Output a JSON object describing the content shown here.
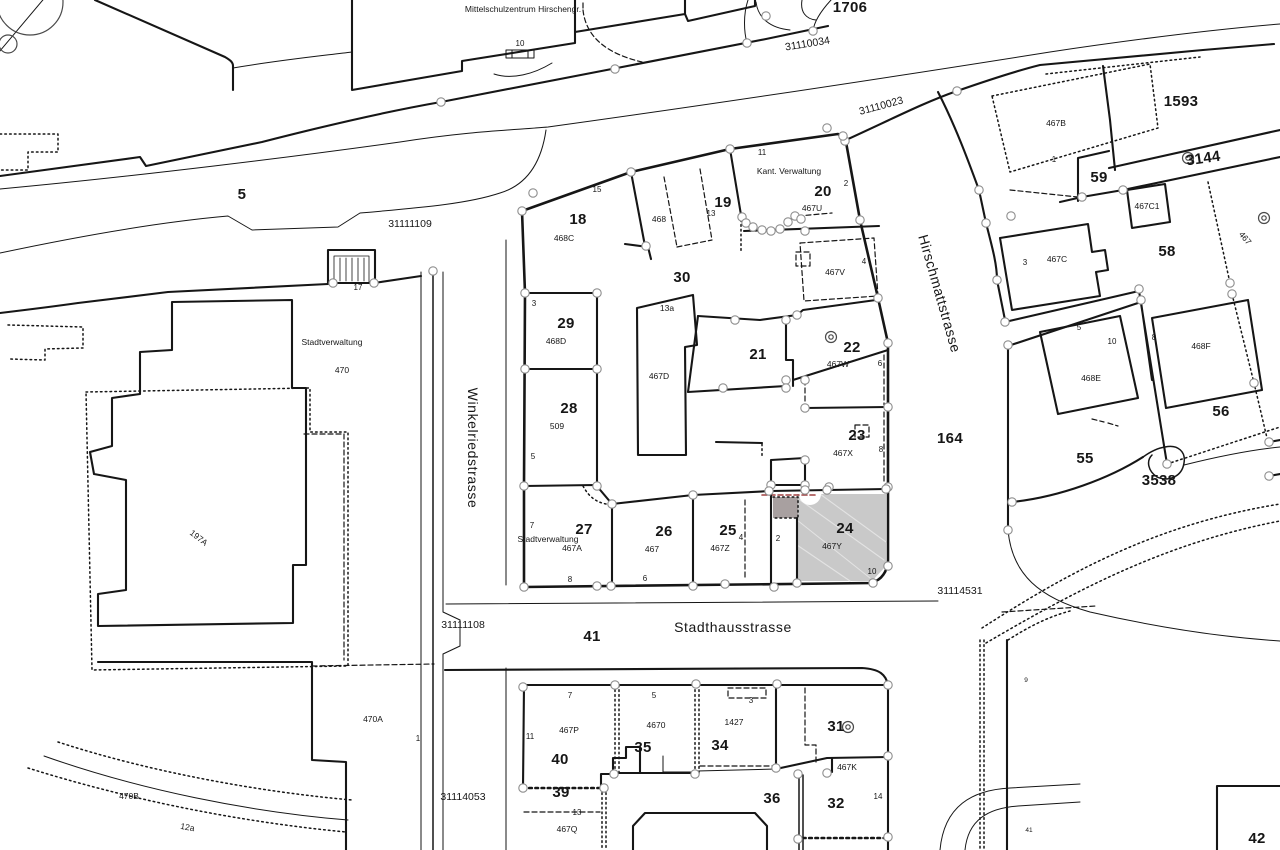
{
  "meta": {
    "map_kind": "cadastral parcel map"
  },
  "colors": {
    "background": "#ffffff",
    "line": "#161616",
    "survey_point_stroke": "#8d8d8d",
    "highlight_parcel_fill": "#c9c9c9",
    "highlight_subarea_fill": "#a8a0a0",
    "annotation_red": "#a04040"
  },
  "streets": [
    "Winkelriedstrasse",
    "Stadthausstrasse",
    "Hirschmattstrasse"
  ],
  "places": [
    "Mittelschulzentrum Hirschengr.",
    "Kant. Verwaltung",
    "Stadtverwaltung"
  ],
  "road_ids": [
    "31110034",
    "31110023",
    "31111109",
    "31111108",
    "31114053",
    "31114531"
  ],
  "highlighted_parcel": {
    "number": "24",
    "building": "467Y"
  },
  "labels": [
    {
      "t": "Mittelschulzentrum Hirschengr.",
      "x": 523,
      "y": 12,
      "c": "note"
    },
    {
      "t": "1706",
      "x": 850,
      "y": 12,
      "c": "p"
    },
    {
      "t": "31110034",
      "x": 808,
      "y": 47,
      "c": "road",
      "r": -9
    },
    {
      "t": "31110023",
      "x": 882,
      "y": 109,
      "c": "road",
      "r": -15
    },
    {
      "t": "10",
      "x": 520,
      "y": 46,
      "c": "h"
    },
    {
      "t": "5",
      "x": 242,
      "y": 199,
      "c": "p"
    },
    {
      "t": "31111109",
      "x": 410,
      "y": 227,
      "c": "road"
    },
    {
      "t": "17",
      "x": 358,
      "y": 290,
      "c": "h"
    },
    {
      "t": "Stadtverwaltung",
      "x": 332,
      "y": 345,
      "c": "note"
    },
    {
      "t": "470",
      "x": 342,
      "y": 373,
      "c": "b"
    },
    {
      "t": "197A",
      "x": 197,
      "y": 540,
      "c": "b",
      "r": 38
    },
    {
      "t": "470A",
      "x": 373,
      "y": 722,
      "c": "b"
    },
    {
      "t": "1",
      "x": 418,
      "y": 741,
      "c": "h"
    },
    {
      "t": "470B",
      "x": 129,
      "y": 799,
      "c": "b"
    },
    {
      "t": "12a",
      "x": 187,
      "y": 830,
      "c": "b",
      "r": 10
    },
    {
      "t": "Winkelriedstrasse",
      "x": 468,
      "y": 448,
      "c": "st",
      "r": 90
    },
    {
      "t": "31111108",
      "x": 463,
      "y": 628,
      "c": "road"
    },
    {
      "t": "31114053",
      "x": 463,
      "y": 800,
      "c": "road"
    },
    {
      "t": "18",
      "x": 578,
      "y": 224,
      "c": "p"
    },
    {
      "t": "468C",
      "x": 564,
      "y": 241,
      "c": "b"
    },
    {
      "t": "15",
      "x": 597,
      "y": 192,
      "c": "h"
    },
    {
      "t": "468",
      "x": 659,
      "y": 222,
      "c": "b"
    },
    {
      "t": "19",
      "x": 723,
      "y": 207,
      "c": "p"
    },
    {
      "t": "13",
      "x": 711,
      "y": 216,
      "c": "h"
    },
    {
      "t": "Kant. Verwaltung",
      "x": 789,
      "y": 174,
      "c": "note"
    },
    {
      "t": "20",
      "x": 823,
      "y": 196,
      "c": "p"
    },
    {
      "t": "11",
      "x": 762,
      "y": 155,
      "c": "h"
    },
    {
      "t": "2",
      "x": 846,
      "y": 186,
      "c": "h"
    },
    {
      "t": "467U",
      "x": 812,
      "y": 211,
      "c": "b"
    },
    {
      "t": "467V",
      "x": 835,
      "y": 275,
      "c": "b"
    },
    {
      "t": "4",
      "x": 864,
      "y": 264,
      "c": "h"
    },
    {
      "t": "30",
      "x": 682,
      "y": 282,
      "c": "p"
    },
    {
      "t": "3",
      "x": 534,
      "y": 306,
      "c": "h"
    },
    {
      "t": "29",
      "x": 566,
      "y": 328,
      "c": "p"
    },
    {
      "t": "468D",
      "x": 556,
      "y": 344,
      "c": "b"
    },
    {
      "t": "28",
      "x": 569,
      "y": 413,
      "c": "p"
    },
    {
      "t": "509",
      "x": 557,
      "y": 429,
      "c": "b"
    },
    {
      "t": "5",
      "x": 533,
      "y": 459,
      "c": "h"
    },
    {
      "t": "13a",
      "x": 667,
      "y": 311,
      "c": "b"
    },
    {
      "t": "467D",
      "x": 659,
      "y": 379,
      "c": "b"
    },
    {
      "t": "21",
      "x": 758,
      "y": 359,
      "c": "p"
    },
    {
      "t": "22",
      "x": 852,
      "y": 352,
      "c": "p"
    },
    {
      "t": "467W",
      "x": 838,
      "y": 367,
      "c": "b"
    },
    {
      "t": "6",
      "x": 880,
      "y": 366,
      "c": "h"
    },
    {
      "t": "23",
      "x": 857,
      "y": 440,
      "c": "p"
    },
    {
      "t": "467X",
      "x": 843,
      "y": 456,
      "c": "b"
    },
    {
      "t": "8",
      "x": 881,
      "y": 452,
      "c": "h"
    },
    {
      "t": "Hirschmattstrasse",
      "x": 935,
      "y": 295,
      "c": "st",
      "r": 74
    },
    {
      "t": "164",
      "x": 950,
      "y": 443,
      "c": "p"
    },
    {
      "t": "27",
      "x": 584,
      "y": 534,
      "c": "p"
    },
    {
      "t": "Stadtverwaltung",
      "x": 548,
      "y": 542,
      "c": "note"
    },
    {
      "t": "467A",
      "x": 572,
      "y": 551,
      "c": "b"
    },
    {
      "t": "7",
      "x": 532,
      "y": 528,
      "c": "h"
    },
    {
      "t": "8",
      "x": 570,
      "y": 582,
      "c": "h"
    },
    {
      "t": "26",
      "x": 664,
      "y": 536,
      "c": "p"
    },
    {
      "t": "467",
      "x": 652,
      "y": 552,
      "c": "b"
    },
    {
      "t": "6",
      "x": 645,
      "y": 581,
      "c": "h"
    },
    {
      "t": "25",
      "x": 728,
      "y": 535,
      "c": "p"
    },
    {
      "t": "467Z",
      "x": 720,
      "y": 551,
      "c": "b"
    },
    {
      "t": "4",
      "x": 741,
      "y": 540,
      "c": "h"
    },
    {
      "t": "24",
      "x": 845,
      "y": 533,
      "c": "p"
    },
    {
      "t": "467Y",
      "x": 832,
      "y": 549,
      "c": "b"
    },
    {
      "t": "2",
      "x": 778,
      "y": 541,
      "c": "h"
    },
    {
      "t": "10",
      "x": 872,
      "y": 574,
      "c": "h"
    },
    {
      "t": "41",
      "x": 592,
      "y": 641,
      "c": "p"
    },
    {
      "t": "Stadthausstrasse",
      "x": 733,
      "y": 632,
      "c": "st"
    },
    {
      "t": "31114531",
      "x": 960,
      "y": 594,
      "c": "road"
    },
    {
      "t": "40",
      "x": 560,
      "y": 764,
      "c": "p"
    },
    {
      "t": "467P",
      "x": 569,
      "y": 733,
      "c": "b"
    },
    {
      "t": "11",
      "x": 530,
      "y": 739,
      "c": "h"
    },
    {
      "t": "7",
      "x": 570,
      "y": 698,
      "c": "h"
    },
    {
      "t": "35",
      "x": 643,
      "y": 752,
      "c": "p"
    },
    {
      "t": "4670",
      "x": 656,
      "y": 728,
      "c": "b"
    },
    {
      "t": "5",
      "x": 654,
      "y": 698,
      "c": "h"
    },
    {
      "t": "34",
      "x": 720,
      "y": 750,
      "c": "p"
    },
    {
      "t": "1427",
      "x": 734,
      "y": 725,
      "c": "b"
    },
    {
      "t": "3",
      "x": 751,
      "y": 703,
      "c": "h"
    },
    {
      "t": "31",
      "x": 836,
      "y": 731,
      "c": "p"
    },
    {
      "t": "36",
      "x": 772,
      "y": 803,
      "c": "p"
    },
    {
      "t": "32",
      "x": 836,
      "y": 808,
      "c": "p"
    },
    {
      "t": "467K",
      "x": 847,
      "y": 770,
      "c": "b"
    },
    {
      "t": "14",
      "x": 878,
      "y": 799,
      "c": "h"
    },
    {
      "t": "39",
      "x": 561,
      "y": 797,
      "c": "p"
    },
    {
      "t": "13",
      "x": 577,
      "y": 815,
      "c": "h"
    },
    {
      "t": "467Q",
      "x": 567,
      "y": 832,
      "c": "b"
    },
    {
      "t": "467B",
      "x": 1056,
      "y": 126,
      "c": "b"
    },
    {
      "t": "1",
      "x": 1054,
      "y": 162,
      "c": "h"
    },
    {
      "t": "1593",
      "x": 1181,
      "y": 106,
      "c": "p"
    },
    {
      "t": "59",
      "x": 1099,
      "y": 182,
      "c": "p"
    },
    {
      "t": "3144",
      "x": 1204,
      "y": 163,
      "c": "p",
      "r": -8
    },
    {
      "t": "467C1",
      "x": 1147,
      "y": 209,
      "c": "b"
    },
    {
      "t": "58",
      "x": 1167,
      "y": 256,
      "c": "p"
    },
    {
      "t": "467C",
      "x": 1057,
      "y": 262,
      "c": "b"
    },
    {
      "t": "3",
      "x": 1025,
      "y": 265,
      "c": "h"
    },
    {
      "t": "467",
      "x": 1243,
      "y": 240,
      "c": "b",
      "r": 50
    },
    {
      "t": "468E",
      "x": 1091,
      "y": 381,
      "c": "b"
    },
    {
      "t": "5",
      "x": 1079,
      "y": 330,
      "c": "h"
    },
    {
      "t": "10",
      "x": 1112,
      "y": 344,
      "c": "h"
    },
    {
      "t": "8",
      "x": 1154,
      "y": 340,
      "c": "h"
    },
    {
      "t": "468F",
      "x": 1201,
      "y": 349,
      "c": "b"
    },
    {
      "t": "56",
      "x": 1221,
      "y": 416,
      "c": "p"
    },
    {
      "t": "55",
      "x": 1085,
      "y": 463,
      "c": "p"
    },
    {
      "t": "3538",
      "x": 1159,
      "y": 485,
      "c": "p"
    },
    {
      "t": "9",
      "x": 1026,
      "y": 682,
      "c": "tiny"
    },
    {
      "t": "41",
      "x": 1029,
      "y": 832,
      "c": "tiny"
    },
    {
      "t": "42",
      "x": 1257,
      "y": 843,
      "c": "p"
    }
  ],
  "survey_points": [
    [
      441,
      102
    ],
    [
      615,
      69
    ],
    [
      747,
      43
    ],
    [
      813,
      31
    ],
    [
      766,
      16
    ],
    [
      827,
      128
    ],
    [
      845,
      141
    ],
    [
      957,
      91
    ],
    [
      522,
      211
    ],
    [
      533,
      193
    ],
    [
      631,
      172
    ],
    [
      730,
      149
    ],
    [
      843,
      136
    ],
    [
      860,
      220
    ],
    [
      878,
      298
    ],
    [
      888,
      343
    ],
    [
      888,
      407
    ],
    [
      888,
      487
    ],
    [
      888,
      566
    ],
    [
      873,
      583
    ],
    [
      525,
      293
    ],
    [
      597,
      293
    ],
    [
      525,
      369
    ],
    [
      597,
      369
    ],
    [
      524,
      486
    ],
    [
      597,
      486
    ],
    [
      524,
      587
    ],
    [
      597,
      586
    ],
    [
      646,
      246
    ],
    [
      742,
      217
    ],
    [
      746,
      223
    ],
    [
      753,
      227
    ],
    [
      762,
      230
    ],
    [
      771,
      231
    ],
    [
      780,
      229
    ],
    [
      788,
      222
    ],
    [
      795,
      216
    ],
    [
      801,
      219
    ],
    [
      805,
      231
    ],
    [
      735,
      320
    ],
    [
      786,
      320
    ],
    [
      797,
      315
    ],
    [
      723,
      388
    ],
    [
      786,
      380
    ],
    [
      786,
      388
    ],
    [
      805,
      380
    ],
    [
      805,
      408
    ],
    [
      805,
      460
    ],
    [
      771,
      485
    ],
    [
      805,
      485
    ],
    [
      829,
      487
    ],
    [
      612,
      504
    ],
    [
      693,
      495
    ],
    [
      769,
      491
    ],
    [
      805,
      490
    ],
    [
      827,
      490
    ],
    [
      886,
      489
    ],
    [
      611,
      586
    ],
    [
      693,
      586
    ],
    [
      725,
      584
    ],
    [
      774,
      587
    ],
    [
      797,
      583
    ],
    [
      523,
      687
    ],
    [
      615,
      685
    ],
    [
      696,
      684
    ],
    [
      777,
      684
    ],
    [
      888,
      685
    ],
    [
      523,
      788
    ],
    [
      604,
      788
    ],
    [
      614,
      774
    ],
    [
      695,
      774
    ],
    [
      776,
      768
    ],
    [
      798,
      774
    ],
    [
      827,
      773
    ],
    [
      888,
      756
    ],
    [
      798,
      839
    ],
    [
      888,
      837
    ],
    [
      979,
      190
    ],
    [
      986,
      223
    ],
    [
      1011,
      216
    ],
    [
      997,
      280
    ],
    [
      1005,
      322
    ],
    [
      1008,
      345
    ],
    [
      1082,
      197
    ],
    [
      1123,
      190
    ],
    [
      1139,
      289
    ],
    [
      1141,
      300
    ],
    [
      1230,
      283
    ],
    [
      1232,
      294
    ],
    [
      1254,
      383
    ],
    [
      1167,
      464
    ],
    [
      1012,
      502
    ],
    [
      1008,
      530
    ],
    [
      1269,
      442
    ],
    [
      1269,
      476
    ],
    [
      433,
      271
    ],
    [
      333,
      283
    ],
    [
      374,
      283
    ]
  ],
  "benchmarks": [
    [
      831,
      337
    ],
    [
      1188,
      158
    ],
    [
      1264,
      218
    ],
    [
      848,
      727
    ]
  ]
}
